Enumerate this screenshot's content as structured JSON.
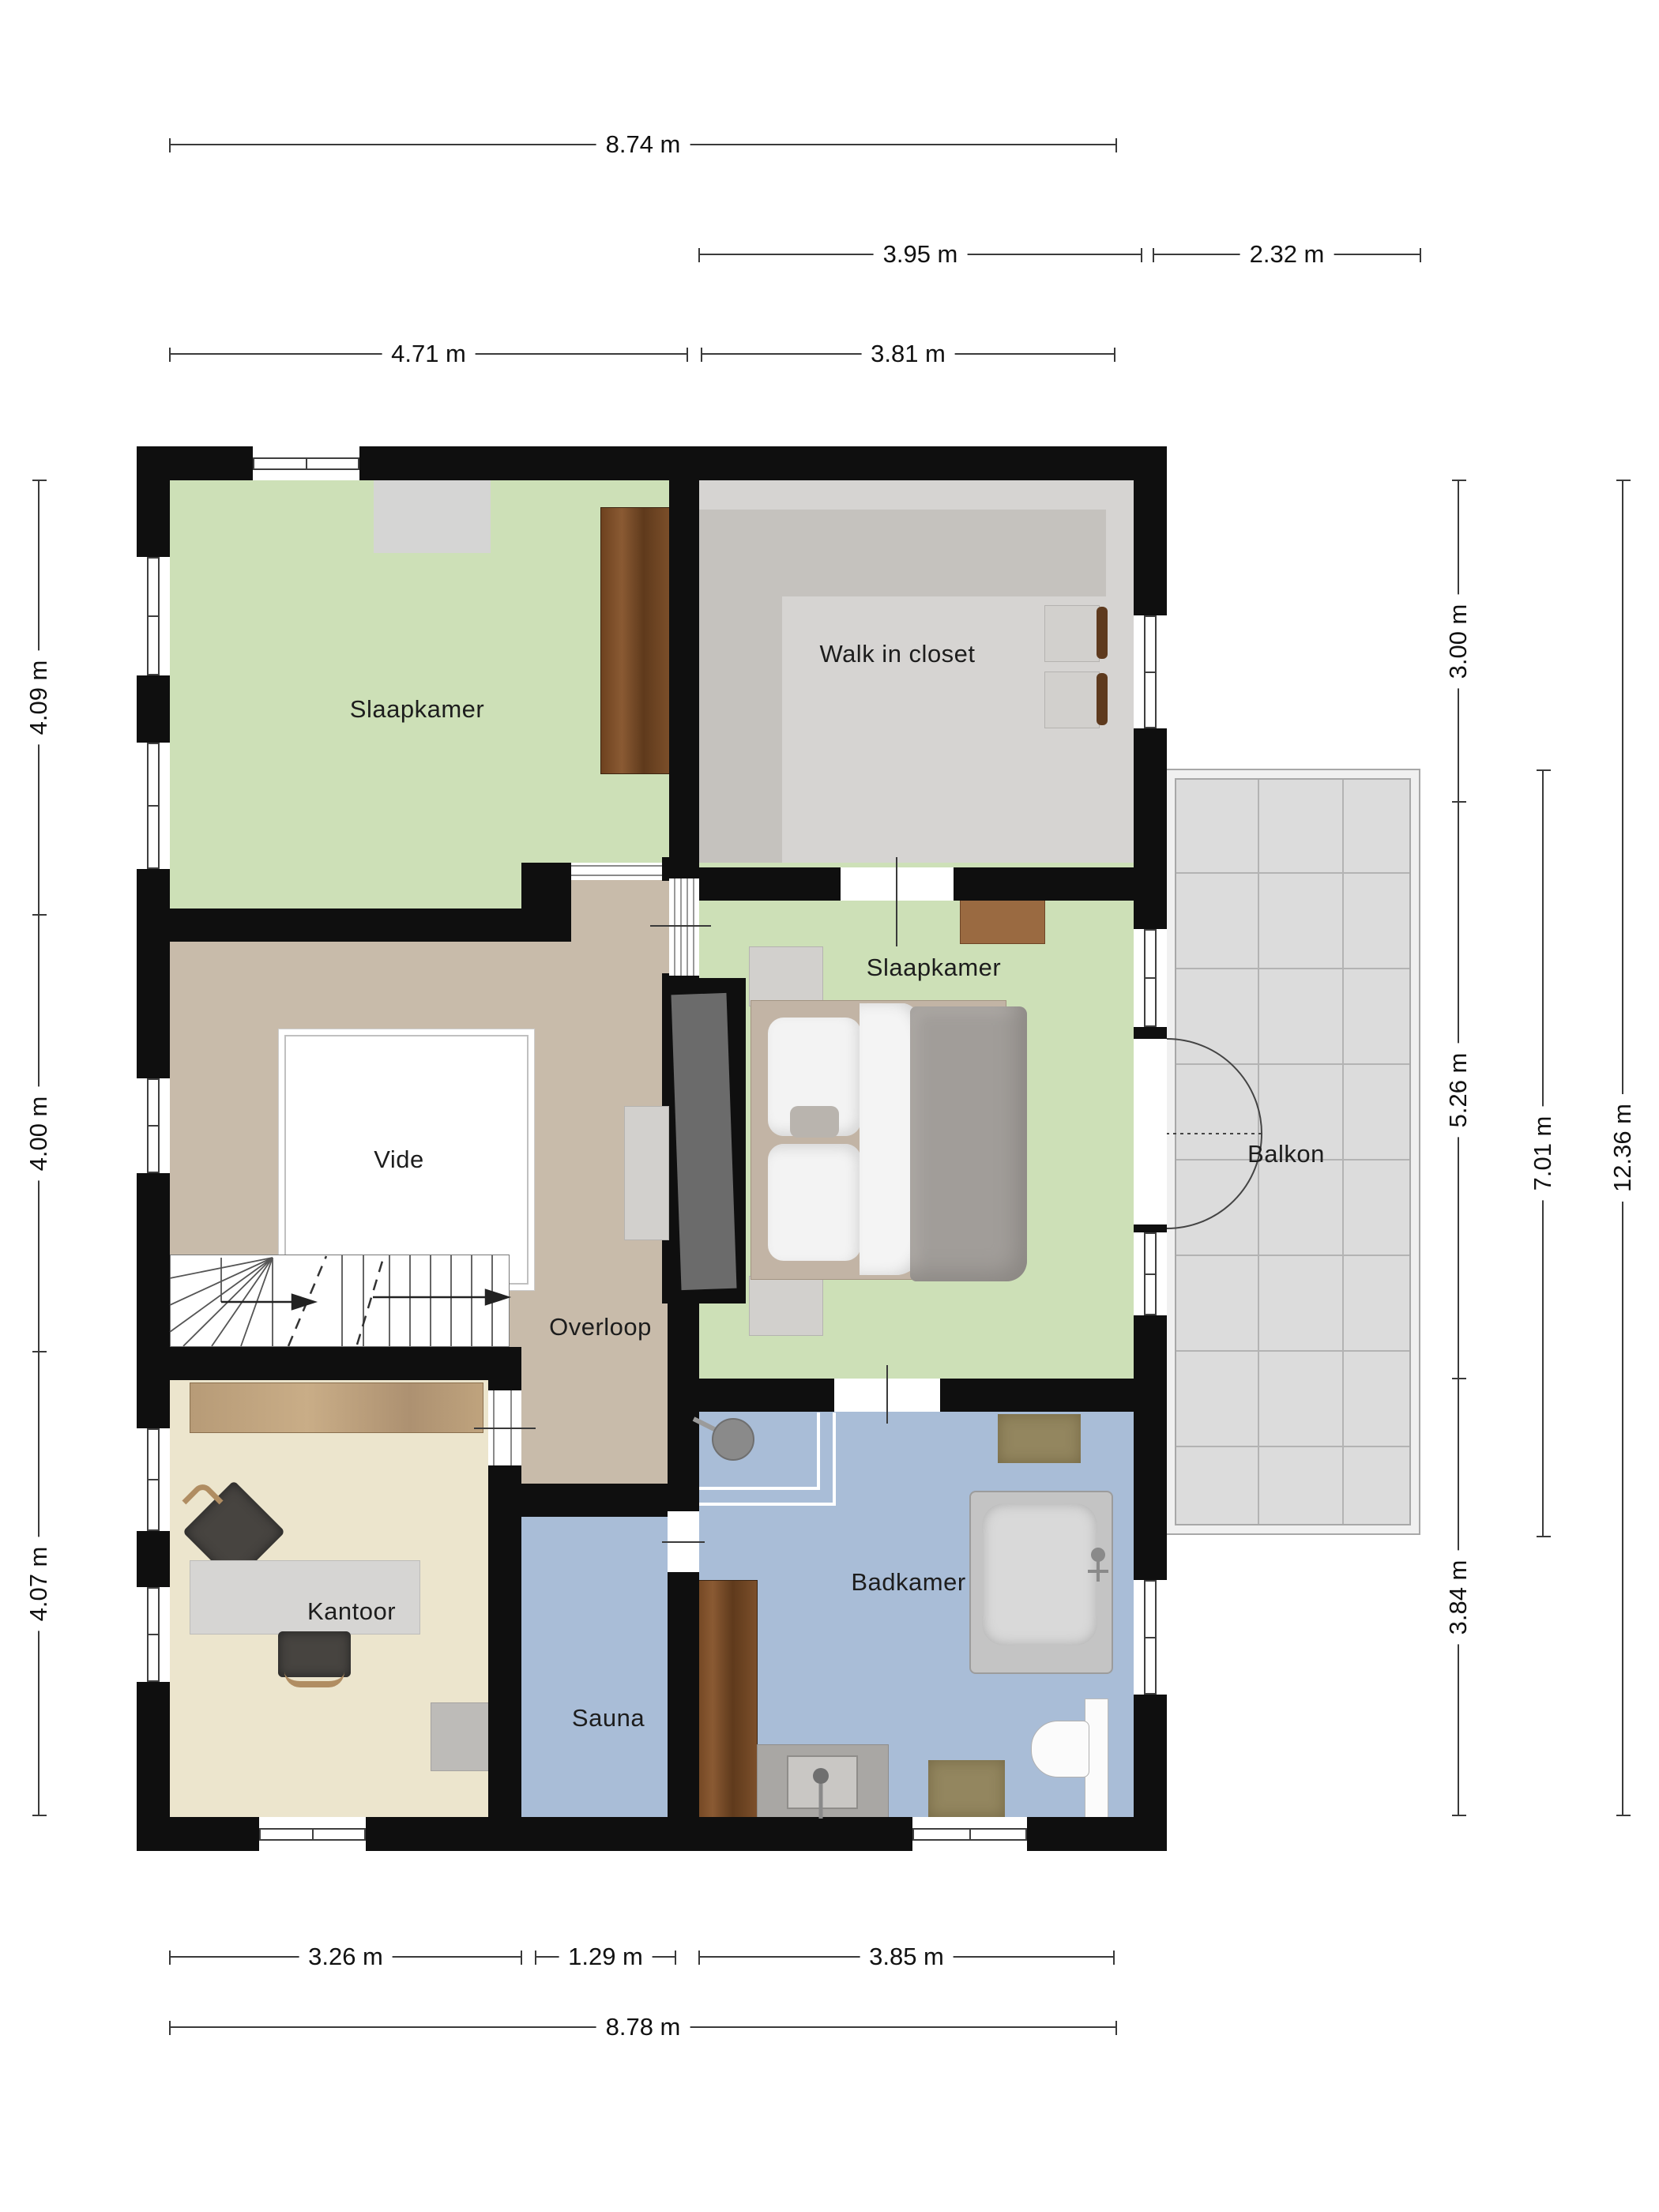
{
  "rooms": {
    "bedroom_top_left": {
      "label": "Slaapkamer"
    },
    "walk_in_closet": {
      "label": "Walk in closet"
    },
    "bedroom_right": {
      "label": "Slaapkamer"
    },
    "vide": {
      "label": "Vide"
    },
    "overloop": {
      "label": "Overloop"
    },
    "balkon": {
      "label": "Balkon"
    },
    "kantoor": {
      "label": "Kantoor"
    },
    "sauna": {
      "label": "Sauna"
    },
    "badkamer": {
      "label": "Badkamer"
    }
  },
  "dimensions": {
    "top": {
      "total": "8.74 m",
      "closet": "3.95 m",
      "balcony": "2.32 m",
      "left_room": "4.71 m",
      "right_room": "3.81 m"
    },
    "left": {
      "top": "4.09 m",
      "middle": "4.00 m",
      "bottom": "4.07 m"
    },
    "right": {
      "closet": "3.00 m",
      "bedroom": "5.26 m",
      "bathroom": "3.84 m",
      "balcony": "7.01 m",
      "total": "12.36 m"
    },
    "bottom": {
      "office": "3.26 m",
      "sauna": "1.29 m",
      "bathroom": "3.85 m",
      "total": "8.78 m"
    }
  },
  "colors": {
    "wall": "#0f0f0f",
    "bedroom-green": "#cde0b7",
    "overloop-taupe": "#c8bbaa",
    "closet-gray": "#d6d4d2",
    "wardrobe-gray": "#c5c2be",
    "bathroom-blue": "#a9bdd7",
    "office-cream": "#ece5cd",
    "balcony-gray": "#dcdcdc",
    "wood-dark": "#7b4a24",
    "wood-light": "#b99c78",
    "bed-gray": "#a19d99",
    "dimension-line": "#3a3a3a"
  }
}
